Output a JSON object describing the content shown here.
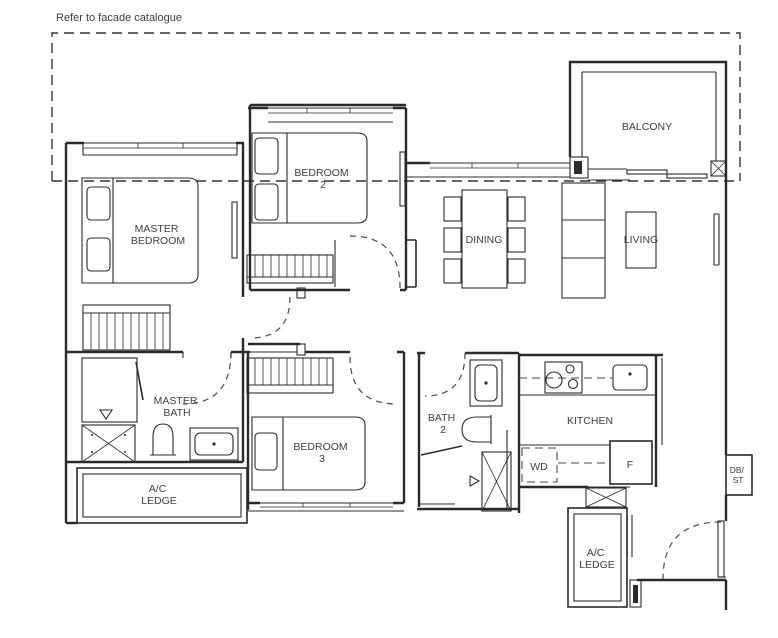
{
  "note": {
    "facade": "Refer to facade catalogue"
  },
  "colors": {
    "line": "#2b2b2b",
    "text": "#3c4146",
    "background": "#ffffff"
  },
  "rooms": {
    "master_bedroom": {
      "lines": [
        "MASTER",
        "BEDROOM"
      ]
    },
    "bedroom_2": {
      "lines": [
        "BEDROOM",
        "2"
      ]
    },
    "bedroom_3": {
      "lines": [
        "BEDROOM",
        "3"
      ]
    },
    "master_bath": {
      "lines": [
        "MASTER",
        "BATH"
      ]
    },
    "bath_2": {
      "lines": [
        "BATH",
        "2"
      ]
    },
    "kitchen": {
      "lines": [
        "KITCHEN"
      ]
    },
    "dining": {
      "lines": [
        "DINING"
      ]
    },
    "living": {
      "lines": [
        "LIVING"
      ]
    },
    "balcony": {
      "lines": [
        "BALCONY"
      ]
    },
    "ac_ledge_left": {
      "lines": [
        "A/C",
        "LEDGE"
      ]
    },
    "ac_ledge_right": {
      "lines": [
        "A/C",
        "LEDGE"
      ]
    },
    "db_st": {
      "lines": [
        "DB/",
        "ST"
      ]
    }
  },
  "appliances": {
    "washer_dryer": "WD",
    "fridge": "F"
  }
}
